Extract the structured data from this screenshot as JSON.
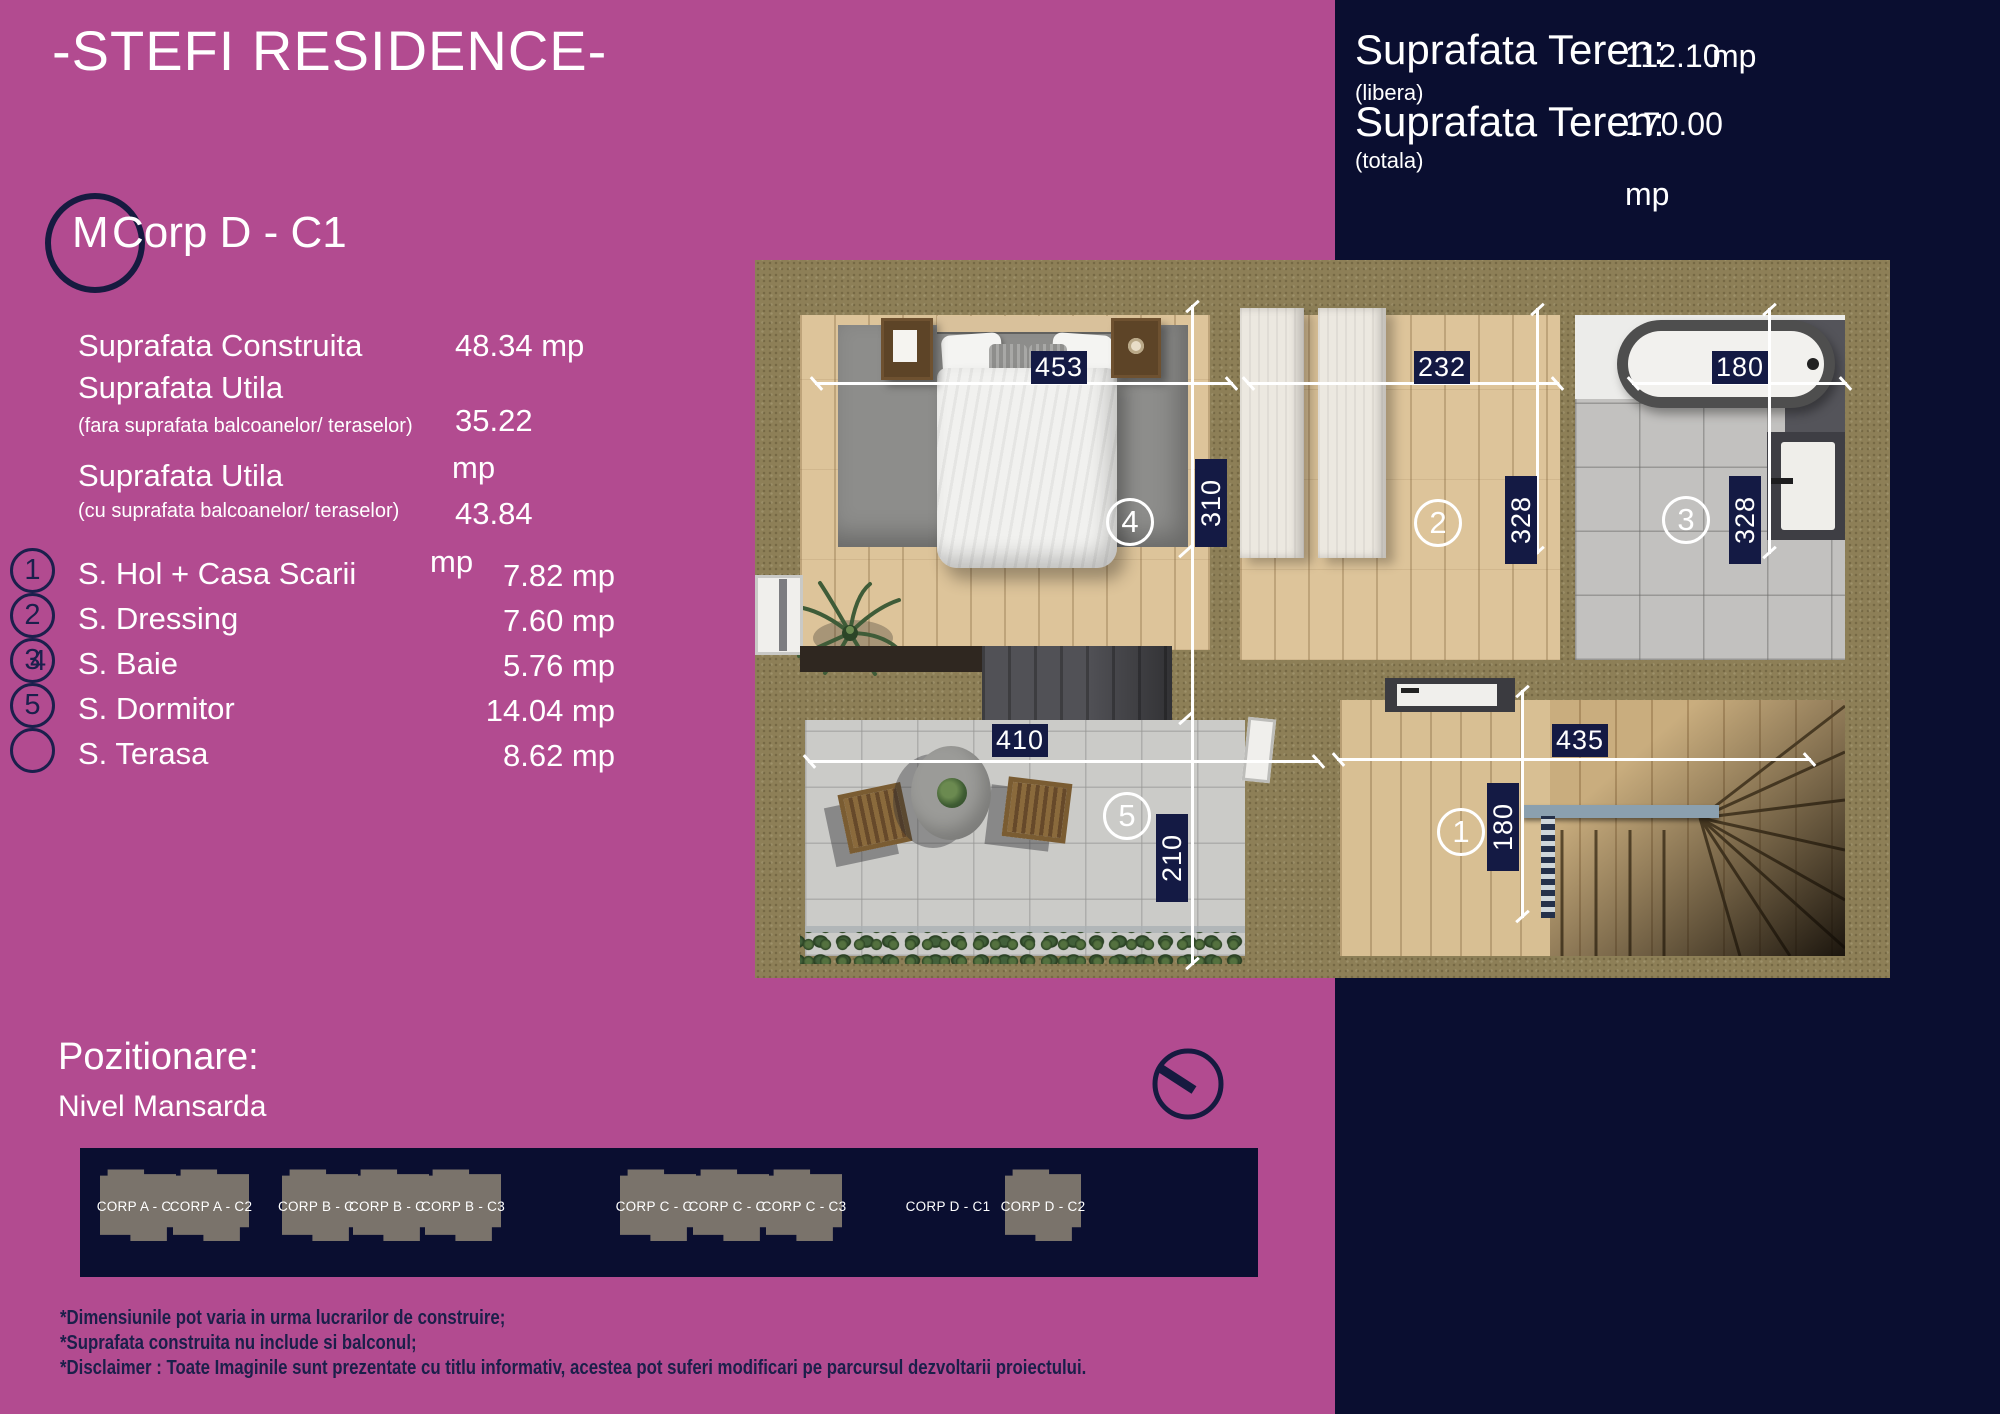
{
  "colors": {
    "magenta": "#b24b90",
    "navy": "#0a0e30",
    "chip_navy": "#141a44",
    "khaki_wall": "#8d7f57",
    "white": "#ffffff"
  },
  "title": "-STEFI RESIDENCE-",
  "unit": {
    "marker": "M",
    "name": "Corp D - C1"
  },
  "teren": {
    "rows": [
      {
        "label": "Suprafata Teren:",
        "sub": "(libera)",
        "value": "112.10",
        "unit": "mp"
      },
      {
        "label": "Suprafata Teren:",
        "sub": "(totala)",
        "value": "170.00",
        "unit": "mp"
      }
    ]
  },
  "stats": {
    "construita": {
      "label": "Suprafata Construita",
      "value": "48.34",
      "unit": "mp"
    },
    "utila_fara": {
      "label": "Suprafata Utila",
      "sub": "(fara suprafata balcoanelor/ teraselor)",
      "value": "35.22",
      "unit": "mp"
    },
    "utila_cu": {
      "label": "Suprafata Utila",
      "sub": "(cu suprafata balcoanelor/ teraselor)",
      "value": "43.84",
      "unit": "mp"
    }
  },
  "rooms": [
    {
      "num": "1",
      "label": "S. Hol + Casa Scarii",
      "value": "7.82 mp"
    },
    {
      "num": "2",
      "label": "S. Dressing",
      "value": "7.60 mp"
    },
    {
      "num": "3",
      "num2": "4",
      "label": "S. Baie",
      "value": "5.76 mp"
    },
    {
      "num": "5",
      "label": "S. Dormitor",
      "value": "14.04 mp"
    },
    {
      "num": "",
      "label": "S. Terasa",
      "value": "8.62 mp"
    }
  ],
  "plan": {
    "dims": {
      "bedroom_w": "453",
      "dressing_w": "232",
      "bath_w": "180",
      "bedroom_h": "310",
      "dressing_h": "328",
      "bath_h": "328",
      "terrace_w": "410",
      "hall_w": "435",
      "terrace_h": "210",
      "hall_h": "180"
    },
    "markers": {
      "bedroom": "4",
      "dressing": "2",
      "bath": "3",
      "terrace": "5",
      "hall": "1"
    }
  },
  "pozitionare": {
    "title": "Pozitionare:",
    "subtitle": "Nivel Mansarda"
  },
  "corpuri": [
    {
      "label": "CORP A - C1",
      "has_shape": true
    },
    {
      "label": "CORP A - C2",
      "has_shape": true
    },
    {
      "label": "CORP B - C1",
      "has_shape": true
    },
    {
      "label": "CORP B - C2",
      "has_shape": true
    },
    {
      "label": "CORP B - C3",
      "has_shape": true
    },
    {
      "label": "CORP C - C1",
      "has_shape": true
    },
    {
      "label": "CORP C - C2",
      "has_shape": true
    },
    {
      "label": "CORP C - C3",
      "has_shape": true
    },
    {
      "label": "CORP D - C1",
      "has_shape": false
    },
    {
      "label": "CORP D - C2",
      "has_shape": true
    }
  ],
  "disclaimers": [
    "*Dimensiunile pot varia in urma lucrarilor de construire;",
    "*Suprafata construita nu include si balconul;",
    "*Disclaimer : Toate Imaginile sunt prezentate cu titlu informativ, acestea pot suferi modificari pe parcursul dezvoltarii proiectului."
  ]
}
